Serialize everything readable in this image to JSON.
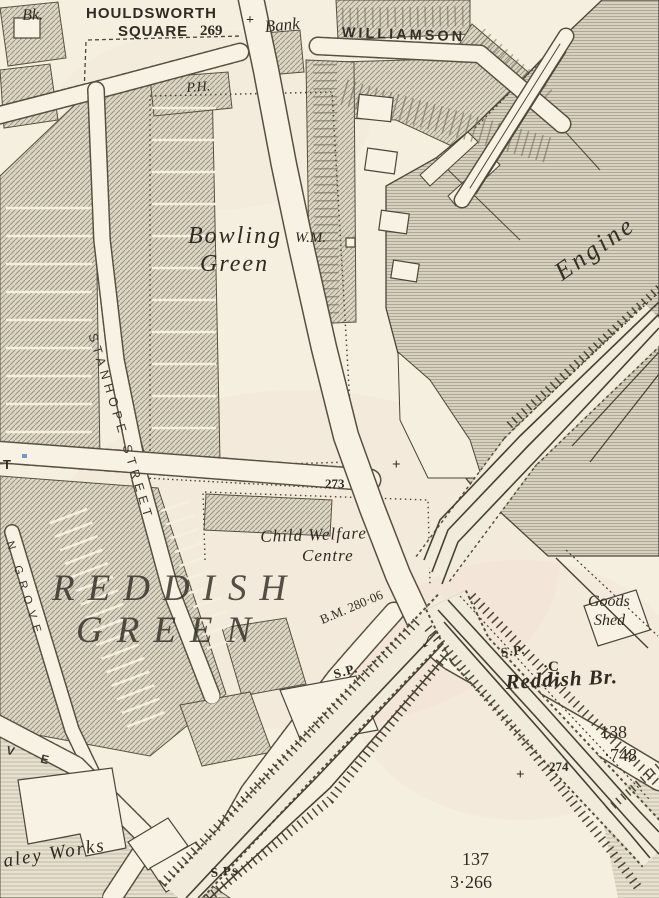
{
  "map": {
    "colors": {
      "paper": "#f5efe0",
      "ink": "#3c382e",
      "hatch_fill": "#dcd6c5",
      "mill_fill": "#d7d1bf",
      "grounds_fill": "#e6e0cf",
      "pink_tint": "#e8c4b8",
      "blue_fleck": "#5b87c9"
    },
    "labels": {
      "bk": "Bk.",
      "houldsworth_line1": "HOULDSWORTH",
      "houldsworth_line2": "SQUARE",
      "spot_269": "269",
      "bank": "Bank",
      "williamson": "WILLIAMSON",
      "public_house": "P.H.",
      "bowling_line1": "Bowling",
      "bowling_line2": "Green",
      "weighing_machine": "W.M.",
      "engine": "Engine",
      "stanhope_street": "STANHOPE STREET",
      "spot_273": "273",
      "child_welfare_line1": "Child Welfare",
      "child_welfare_line2": "Centre",
      "reddish": "REDDISH",
      "green": "GREEN",
      "benchmark": "B.M. 280·06",
      "signal_post_a": "S.P.",
      "signal_post_b": "S.P.",
      "signal_posts": "S.Ps",
      "goods_shed_line1": "Goods",
      "goods_shed_line2": "Shed",
      "crane_mark": "·C",
      "reddish_bridge": "Reddish Br.",
      "parcel_138": "138",
      "acreage_748": "·748",
      "spot_274": "274",
      "parcel_137": "137",
      "acreage_3266": "3·266",
      "works": "aley Works",
      "street_t": "T",
      "n_grove": "N GROVE",
      "street_ve": "V E"
    },
    "symbols": {
      "boundary_cross": "+",
      "gradient_arrow": "↓"
    }
  }
}
